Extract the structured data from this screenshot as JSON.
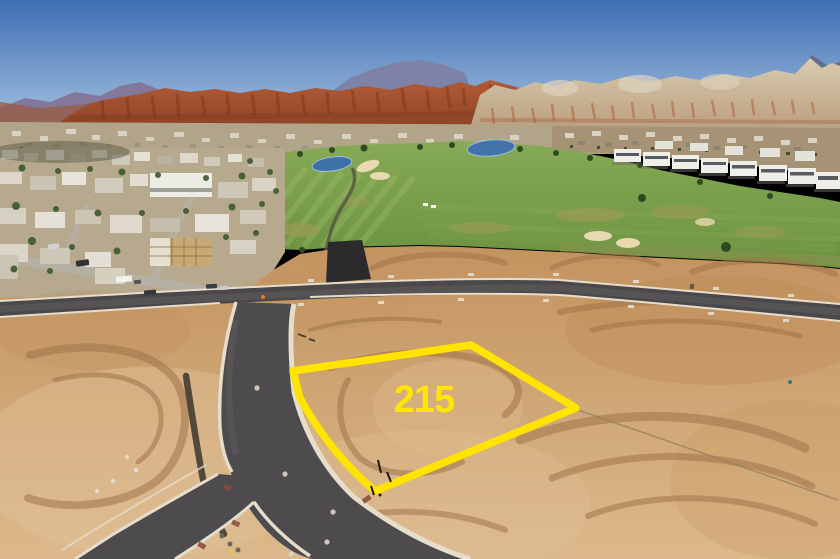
{
  "lot": {
    "number": "215",
    "outline_color": "#FFE400",
    "label_color": "#FFE600"
  },
  "palette": {
    "sky_top": "#3E6DB3",
    "sky_horizon": "#AEC9E4",
    "mountain_haze": "#84789A",
    "mountain_distant": "#7D82A6",
    "red_cliffs": "#A8512F",
    "white_mesa": "#CDBA9C",
    "valley": "#B2A489",
    "hillside": "#A69274",
    "golf_green": "#79A04B",
    "pond_blue": "#4070A8",
    "sand_bunker": "#E8D9B0",
    "rough_olive": "#9C9A58",
    "dirt": "#CB9D6C",
    "dirt_dark": "#A1744A",
    "dirt_pale": "#E0C096",
    "asphalt": "#4A484A",
    "asphalt_new": "#2B2B2D",
    "curb": "#E6DDCB",
    "house_white": "#E9E7E0",
    "condo_white": "#EFEEE9",
    "tree_green": "#3F5A2E"
  }
}
